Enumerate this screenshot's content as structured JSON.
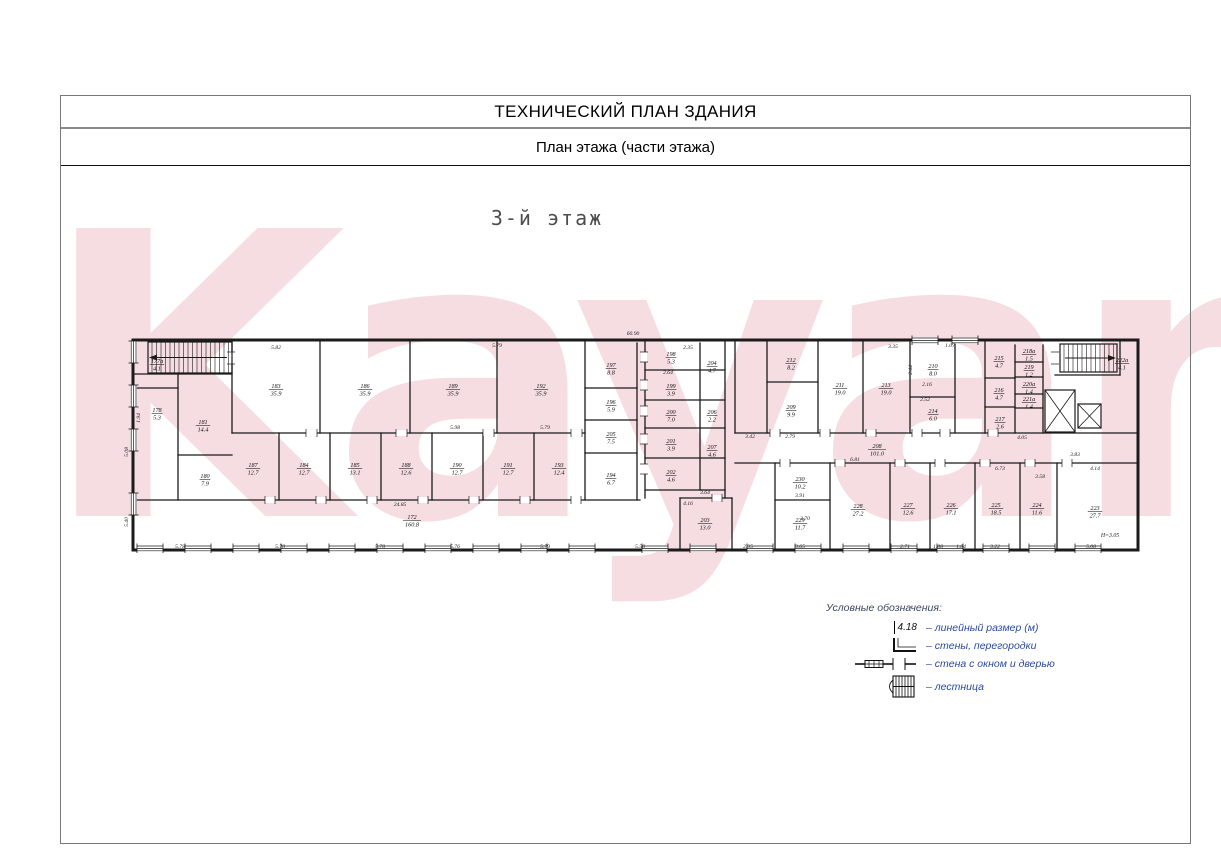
{
  "header": {
    "title": "ТЕХНИЧЕСКИЙ ПЛАН ЗДАНИЯ",
    "subtitle": "План этажа (части этажа)"
  },
  "floor_label": "3-й этаж",
  "watermark": {
    "text": "Kayan",
    "color": "rgba(216,98,125,0.22)"
  },
  "legend": {
    "title": "Условные обозначения:",
    "dim_value": "4.18",
    "items": [
      {
        "symbol": "dimension",
        "label": "– линейный размер (м)"
      },
      {
        "symbol": "walls",
        "label": "– стены, перегородки"
      },
      {
        "symbol": "window-door",
        "label": "– стена с окном и дверью"
      },
      {
        "symbol": "stairs",
        "label": "– лестница"
      }
    ]
  },
  "plan": {
    "total_length": "60.90",
    "height_note": "Н=3.05",
    "wall_color": "#1b1b1b",
    "walls": [
      [
        133,
        340,
        1138,
        340,
        3
      ],
      [
        133,
        550,
        1138,
        550,
        3
      ],
      [
        133,
        340,
        133,
        550,
        3
      ],
      [
        1138,
        340,
        1138,
        550,
        3
      ],
      [
        133,
        374,
        232,
        374,
        1.3
      ],
      [
        232,
        340,
        232,
        433,
        1.3
      ],
      [
        133,
        388,
        178,
        388,
        1.3
      ],
      [
        178,
        374,
        178,
        500,
        1.3
      ],
      [
        178,
        455,
        232,
        455,
        1.3
      ],
      [
        232,
        433,
        585,
        433,
        1.3
      ],
      [
        320,
        340,
        320,
        433,
        1.3
      ],
      [
        410,
        340,
        410,
        433,
        1.3
      ],
      [
        497,
        340,
        497,
        433,
        1.3
      ],
      [
        585,
        340,
        585,
        500,
        1.3
      ],
      [
        133,
        500,
        640,
        500,
        1.3
      ],
      [
        279,
        433,
        279,
        500,
        1.3
      ],
      [
        330,
        433,
        330,
        500,
        1.3
      ],
      [
        381,
        433,
        381,
        500,
        1.3
      ],
      [
        432,
        433,
        432,
        500,
        1.3
      ],
      [
        483,
        433,
        483,
        500,
        1.3
      ],
      [
        534,
        433,
        534,
        500,
        1.3
      ],
      [
        637,
        343,
        637,
        500,
        1.3
      ],
      [
        585,
        388,
        637,
        388,
        1.3
      ],
      [
        585,
        420,
        637,
        420,
        1.3
      ],
      [
        585,
        453,
        637,
        453,
        1.3
      ],
      [
        645,
        340,
        645,
        498,
        1.3
      ],
      [
        725,
        340,
        725,
        498,
        1.3
      ],
      [
        700,
        343,
        700,
        490,
        1.3
      ],
      [
        645,
        370,
        725,
        370,
        1.3
      ],
      [
        645,
        400,
        725,
        400,
        1.3
      ],
      [
        645,
        428,
        725,
        428,
        1.3
      ],
      [
        645,
        458,
        725,
        458,
        1.3
      ],
      [
        645,
        490,
        725,
        490,
        1.3
      ],
      [
        680,
        498,
        732,
        498,
        1.3
      ],
      [
        680,
        498,
        680,
        550,
        1.3
      ],
      [
        732,
        498,
        732,
        550,
        1.3
      ],
      [
        735,
        340,
        735,
        433,
        1.3
      ],
      [
        767,
        340,
        767,
        433,
        1.3
      ],
      [
        818,
        340,
        818,
        433,
        1.3
      ],
      [
        863,
        340,
        863,
        433,
        1.3
      ],
      [
        910,
        340,
        910,
        433,
        1.3
      ],
      [
        955,
        340,
        955,
        433,
        1.3
      ],
      [
        767,
        382,
        818,
        382,
        1.3
      ],
      [
        910,
        397,
        955,
        397,
        1.3
      ],
      [
        735,
        433,
        1138,
        433,
        1.3
      ],
      [
        735,
        463,
        1138,
        463,
        1.3
      ],
      [
        775,
        463,
        775,
        550,
        1.3
      ],
      [
        830,
        463,
        830,
        550,
        1.3
      ],
      [
        890,
        463,
        890,
        550,
        1.3
      ],
      [
        930,
        463,
        930,
        550,
        1.3
      ],
      [
        975,
        463,
        975,
        550,
        1.3
      ],
      [
        1020,
        463,
        1020,
        550,
        1.3
      ],
      [
        1057,
        463,
        1057,
        550,
        1.3
      ],
      [
        775,
        500,
        830,
        500,
        1.3
      ],
      [
        985,
        340,
        985,
        433,
        1.3
      ],
      [
        1015,
        345,
        1015,
        433,
        1.3
      ],
      [
        1043,
        345,
        1043,
        433,
        1.3
      ],
      [
        985,
        378,
        1015,
        378,
        1.3
      ],
      [
        985,
        407,
        1015,
        407,
        1.3
      ],
      [
        1015,
        362,
        1043,
        362,
        1.3
      ],
      [
        1015,
        377,
        1043,
        377,
        1.3
      ],
      [
        1015,
        394,
        1043,
        394,
        1.3
      ],
      [
        1015,
        408,
        1043,
        408,
        1.3
      ],
      [
        1055,
        375,
        1120,
        375,
        1.3
      ],
      [
        1120,
        340,
        1120,
        375,
        1.3
      ]
    ],
    "door_gaps": [
      [
        265,
        497,
        10,
        6
      ],
      [
        316,
        497,
        10,
        6
      ],
      [
        367,
        497,
        10,
        6
      ],
      [
        418,
        497,
        10,
        6
      ],
      [
        469,
        497,
        10,
        6
      ],
      [
        520,
        497,
        10,
        6
      ],
      [
        571,
        497,
        10,
        6
      ],
      [
        306,
        430,
        11,
        6
      ],
      [
        396,
        430,
        11,
        6
      ],
      [
        483,
        430,
        11,
        6
      ],
      [
        571,
        430,
        11,
        6
      ],
      [
        641,
        352,
        6,
        10
      ],
      [
        641,
        380,
        6,
        10
      ],
      [
        641,
        406,
        6,
        10
      ],
      [
        641,
        434,
        6,
        10
      ],
      [
        641,
        464,
        6,
        10
      ],
      [
        712,
        495,
        10,
        6
      ],
      [
        228,
        352,
        6,
        12
      ],
      [
        1052,
        352,
        6,
        12
      ],
      [
        770,
        430,
        10,
        6
      ],
      [
        820,
        430,
        10,
        6
      ],
      [
        866,
        430,
        10,
        6
      ],
      [
        912,
        430,
        10,
        6
      ],
      [
        940,
        430,
        10,
        6
      ],
      [
        988,
        430,
        10,
        6
      ],
      [
        780,
        460,
        10,
        6
      ],
      [
        835,
        460,
        10,
        6
      ],
      [
        895,
        460,
        10,
        6
      ],
      [
        935,
        460,
        10,
        6
      ],
      [
        980,
        460,
        10,
        6
      ],
      [
        1025,
        460,
        10,
        6
      ],
      [
        1062,
        460,
        10,
        6
      ]
    ],
    "windows": {
      "bottom": [
        150,
        198,
        246,
        294,
        342,
        390,
        438,
        486,
        534,
        582,
        655,
        703,
        760,
        808,
        856,
        904,
        950,
        996,
        1042,
        1088
      ],
      "left": [
        352,
        396,
        440,
        504
      ],
      "top": [
        925,
        965
      ]
    },
    "stairs": [
      {
        "x": 148,
        "y": 342,
        "w": 84,
        "h": 31,
        "dir": "left"
      },
      {
        "x": 1060,
        "y": 344,
        "w": 57,
        "h": 28,
        "dir": "right"
      }
    ],
    "elevators": [
      {
        "x": 1045,
        "y": 390,
        "w": 30,
        "h": 42
      },
      {
        "x": 1078,
        "y": 404,
        "w": 23,
        "h": 24
      }
    ],
    "rooms": [
      [
        "177а",
        "4.1",
        157,
        363
      ],
      [
        "183",
        "35.9",
        276,
        388
      ],
      [
        "186",
        "35.9",
        365,
        388
      ],
      [
        "189",
        "35.9",
        453,
        388
      ],
      [
        "192",
        "35.9",
        541,
        388
      ],
      [
        "178",
        "5.3",
        157,
        412
      ],
      [
        "181",
        "14.4",
        203,
        424
      ],
      [
        "180",
        "7.9",
        205,
        478
      ],
      [
        "187",
        "12.7",
        253,
        467
      ],
      [
        "184",
        "12.7",
        304,
        467
      ],
      [
        "185",
        "13.1",
        355,
        467
      ],
      [
        "188",
        "12.6",
        406,
        467
      ],
      [
        "190",
        "12.7",
        457,
        467
      ],
      [
        "191",
        "12.7",
        508,
        467
      ],
      [
        "193",
        "12.4",
        559,
        467
      ],
      [
        "172",
        "160.8",
        412,
        519
      ],
      [
        "197",
        "8.8",
        611,
        367
      ],
      [
        "196",
        "5.9",
        611,
        404
      ],
      [
        "205",
        "7.5",
        611,
        436
      ],
      [
        "194",
        "6.7",
        611,
        477
      ],
      [
        "198",
        "5.3",
        671,
        356
      ],
      [
        "204",
        "4.7",
        712,
        365
      ],
      [
        "199",
        "3.9",
        671,
        388
      ],
      [
        "200",
        "7.0",
        671,
        414
      ],
      [
        "206",
        "2.2",
        712,
        414
      ],
      [
        "201",
        "3.9",
        671,
        443
      ],
      [
        "207",
        "4.6",
        712,
        449
      ],
      [
        "202",
        "4.6",
        671,
        474
      ],
      [
        "203",
        "13.0",
        705,
        522
      ],
      [
        "212",
        "8.2",
        791,
        362
      ],
      [
        "209",
        "9.9",
        791,
        409
      ],
      [
        "211",
        "19.0",
        840,
        387
      ],
      [
        "213",
        "19.0",
        886,
        387
      ],
      [
        "210",
        "8.0",
        933,
        368
      ],
      [
        "214",
        "6.0",
        933,
        413
      ],
      [
        "208",
        "101.0",
        877,
        448
      ],
      [
        "215",
        "4.7",
        999,
        360
      ],
      [
        "218а",
        "1.5",
        1029,
        353
      ],
      [
        "219",
        "1.2",
        1029,
        369
      ],
      [
        "216",
        "4.7",
        999,
        392
      ],
      [
        "220а",
        "1.4",
        1029,
        386
      ],
      [
        "221а",
        "1.4",
        1029,
        401
      ],
      [
        "217",
        "2.6",
        1000,
        421
      ],
      [
        "222а",
        "4.1",
        1122,
        362
      ],
      [
        "230",
        "10.2",
        800,
        481
      ],
      [
        "229",
        "11.7",
        800,
        522
      ],
      [
        "228",
        "27.2",
        858,
        508
      ],
      [
        "227",
        "12.6",
        908,
        507
      ],
      [
        "226",
        "17.1",
        951,
        507
      ],
      [
        "225",
        "18.5",
        996,
        507
      ],
      [
        "224",
        "11.6",
        1037,
        507
      ],
      [
        "223",
        "27.7",
        1095,
        510
      ]
    ],
    "dims": [
      [
        "60.90",
        633,
        335,
        0
      ],
      [
        "5.82",
        276,
        349,
        0
      ],
      [
        "5.79",
        497,
        347,
        0
      ],
      [
        "2.35",
        688,
        349,
        0
      ],
      [
        "3.35",
        893,
        348,
        0
      ],
      [
        "1.07",
        950,
        347,
        0
      ],
      [
        "5.98",
        455,
        429,
        0
      ],
      [
        "5.79",
        545,
        429,
        0
      ],
      [
        "5.78",
        180,
        548,
        0
      ],
      [
        "5.78",
        280,
        548,
        0
      ],
      [
        "5.78",
        380,
        548,
        0
      ],
      [
        "5.76",
        455,
        548,
        0
      ],
      [
        "5.79",
        545,
        548,
        0
      ],
      [
        "5.58",
        640,
        548,
        0
      ],
      [
        "2.35",
        748,
        548,
        0
      ],
      [
        "3.65",
        800,
        548,
        0
      ],
      [
        "2.71",
        905,
        548,
        0
      ],
      [
        "1.88",
        938,
        548,
        0
      ],
      [
        "1.84",
        961,
        548,
        0
      ],
      [
        "3.22",
        995,
        548,
        0
      ],
      [
        "5.08",
        1091,
        548,
        0
      ],
      [
        "5.08",
        128,
        452,
        1
      ],
      [
        "5.40",
        128,
        522,
        1
      ],
      [
        "1.94",
        140,
        418,
        1
      ],
      [
        "2.44",
        912,
        370,
        1
      ],
      [
        "24.85",
        400,
        506,
        0
      ],
      [
        "3.42",
        750,
        438,
        0
      ],
      [
        "2.79",
        790,
        438,
        0
      ],
      [
        "6.81",
        855,
        461,
        0
      ],
      [
        "3.91",
        800,
        497,
        0
      ],
      [
        "3.70",
        805,
        520,
        0
      ],
      [
        "6.73",
        1000,
        470,
        0
      ],
      [
        "4.14",
        1095,
        470,
        0
      ],
      [
        "3.58",
        1040,
        478,
        0
      ],
      [
        "3.83",
        1075,
        456,
        0
      ],
      [
        "4.05",
        1022,
        439,
        0
      ],
      [
        "2.64",
        668,
        374,
        0
      ],
      [
        "2.52",
        925,
        401,
        0
      ],
      [
        "2.16",
        927,
        386,
        0
      ],
      [
        "3.64",
        705,
        494,
        0
      ],
      [
        "4.16",
        688,
        505,
        0
      ]
    ]
  }
}
